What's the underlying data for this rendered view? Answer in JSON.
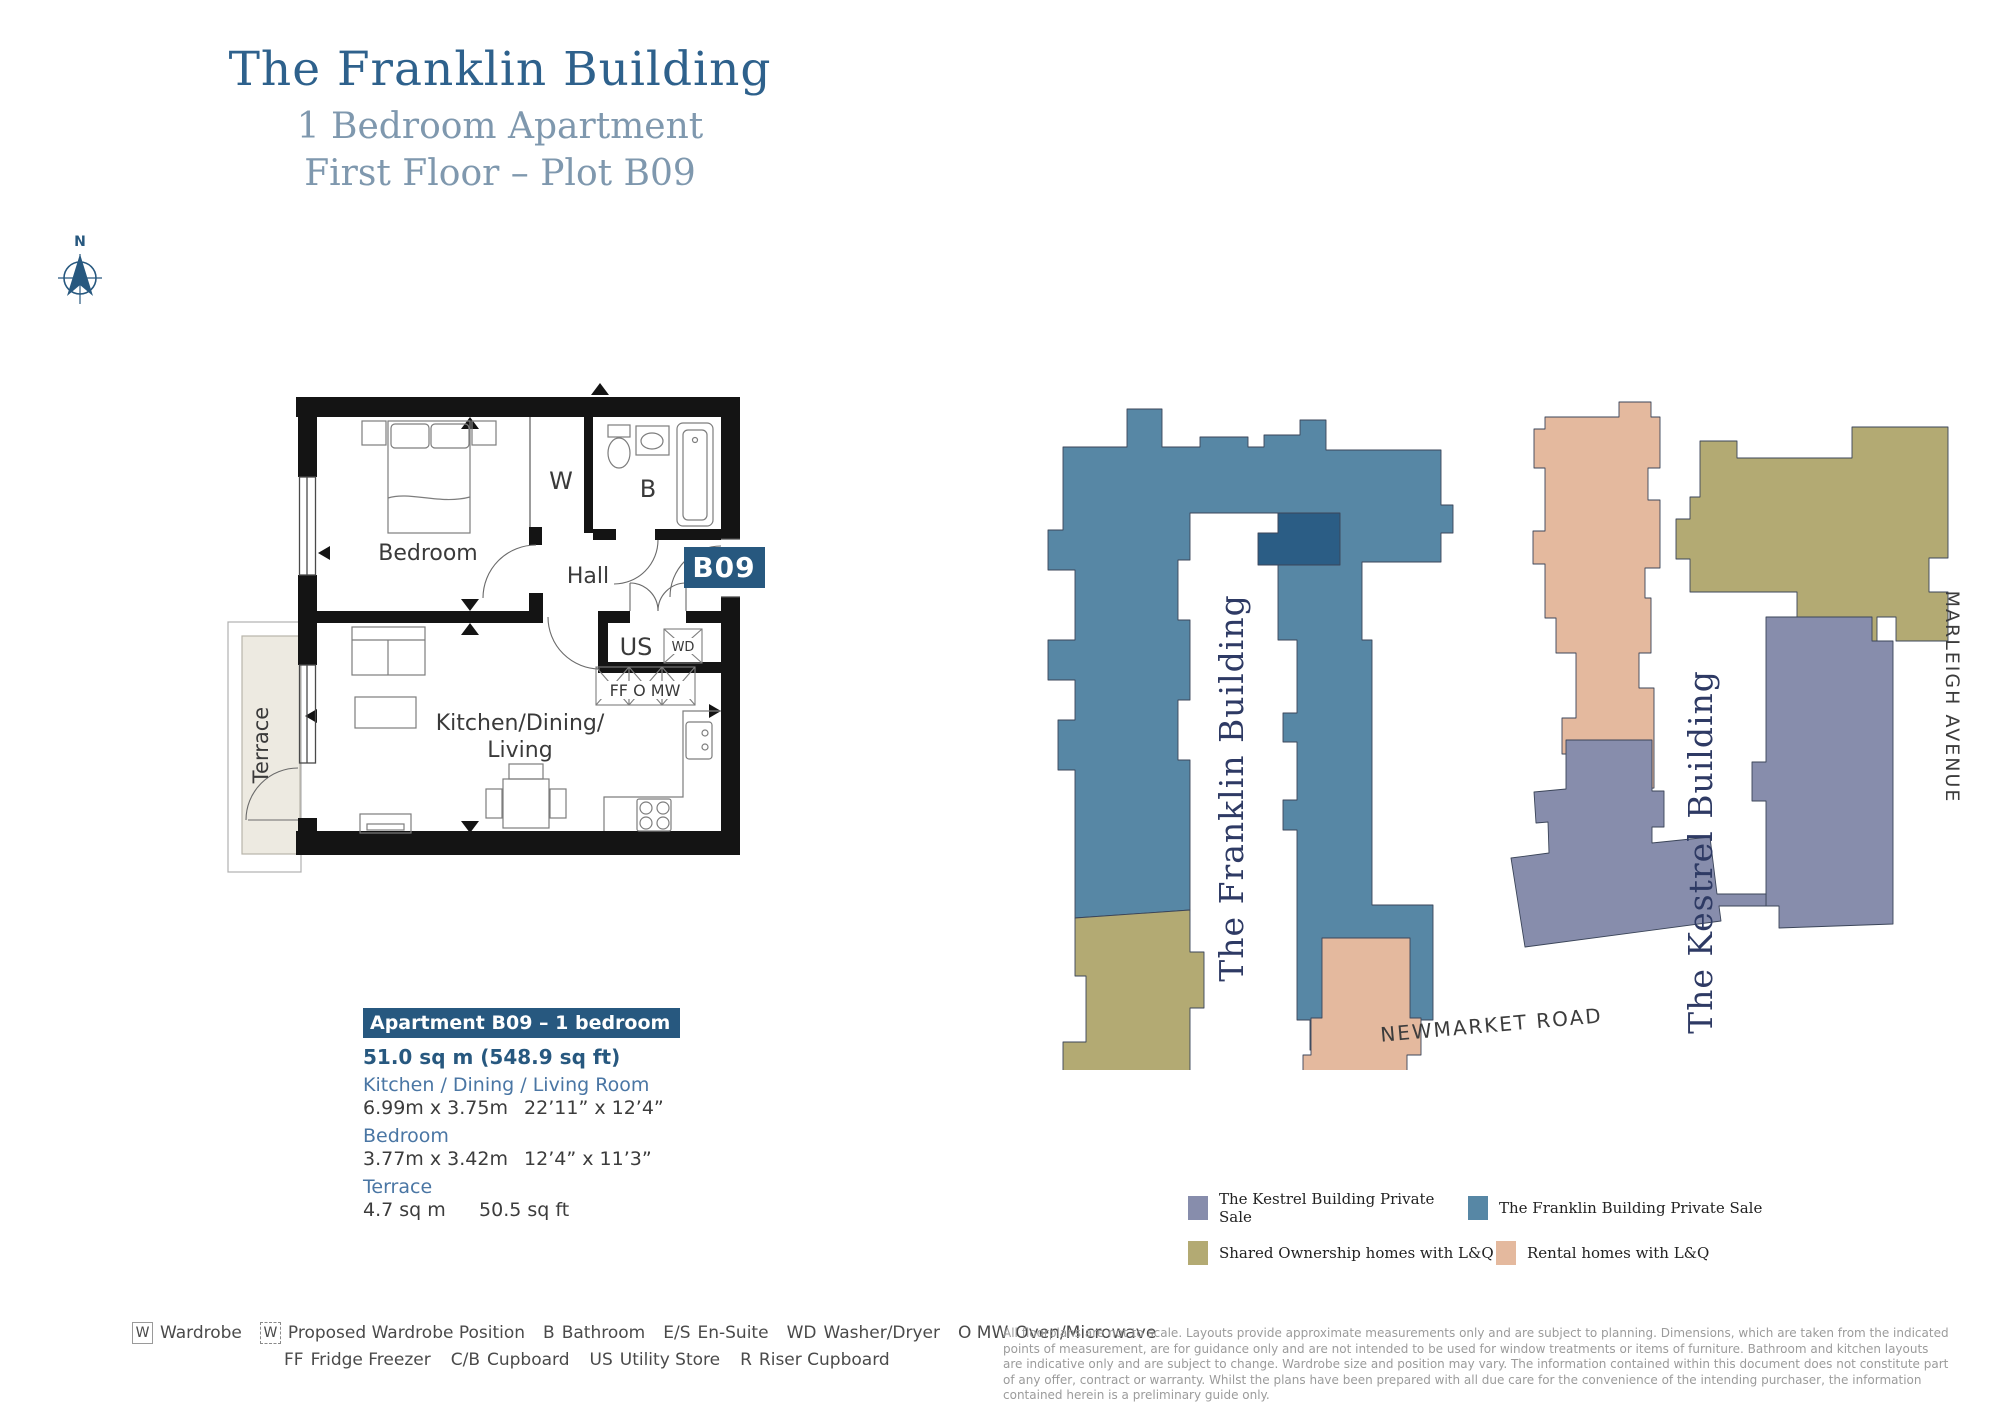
{
  "title": {
    "line1": "The Franklin Building",
    "line2": "1 Bedroom Apartment",
    "line3": "First Floor – Plot B09"
  },
  "compass": {
    "north": "N"
  },
  "floorplan": {
    "badge": "B09",
    "labels": {
      "bedroom": "Bedroom",
      "hall": "Hall",
      "wardrobe": "W",
      "bathroom": "B",
      "utility_store": "US",
      "washer_dryer": "WD",
      "appliances": "FF O MW",
      "kitchen_line1": "Kitchen/Dining/",
      "kitchen_line2": "Living",
      "terrace": "Terrace"
    }
  },
  "apartment_info": {
    "header": "Apartment B09 – 1 bedroom",
    "area": "51.0 sq m (548.9 sq ft)",
    "rooms": [
      {
        "name": "Kitchen / Dining / Living Room",
        "metric": "6.99m x 3.75m",
        "imperial": "22’11” x 12’4”"
      },
      {
        "name": "Bedroom",
        "metric": "3.77m x 3.42m",
        "imperial": "12’4” x 11’3”"
      },
      {
        "name": "Terrace",
        "metric": "4.7 sq m",
        "imperial": "50.5 sq ft"
      }
    ]
  },
  "site_plan": {
    "franklin_label": "The Franklin Building",
    "kestrel_label": "The Kestrel Building",
    "road_bottom": "NEWMARKET ROAD",
    "road_right": "MARLEIGH AVENUE"
  },
  "legend": {
    "items": [
      {
        "label": "The Kestrel Building Private Sale"
      },
      {
        "label": "The Franklin Building Private Sale"
      },
      {
        "label": "Shared Ownership homes with L&Q"
      },
      {
        "label": "Rental homes with L&Q"
      }
    ]
  },
  "key": {
    "row1": [
      {
        "abbr": "W",
        "label": "Wardrobe"
      },
      {
        "abbr": "W",
        "label": "Proposed Wardrobe Position"
      },
      {
        "abbr": "B",
        "label": "Bathroom"
      },
      {
        "abbr": "E/S",
        "label": "En-Suite"
      },
      {
        "abbr": "WD",
        "label": "Washer/Dryer"
      },
      {
        "abbr": "O MW",
        "label": "Oven/Microwave"
      }
    ],
    "row2": [
      {
        "abbr": "FF",
        "label": "Fridge Freezer"
      },
      {
        "abbr": "C/B",
        "label": "Cupboard"
      },
      {
        "abbr": "US",
        "label": "Utility Store"
      },
      {
        "abbr": "R",
        "label": "Riser Cupboard"
      }
    ]
  },
  "disclaimer": "All floorplans are not to scale. Layouts provide approximate measurements only and are subject to planning. Dimensions, which are taken from the indicated points of measurement, are for guidance only and are not intended to be used for window treatments or items of furniture. Bathroom and kitchen layouts are indicative only and are subject to change. Wardrobe size and position may vary. The information contained within this document does not constitute part of any offer, contract or warranty. Whilst the plans have been prepared with all due care for the convenience of the intending purchaser, the information contained herein is a preliminary guide only.",
  "colors": {
    "brand": "#27587f",
    "title": "#2e618c",
    "subtitle": "#7f98ae",
    "franklin": "#5787a5",
    "franklin_highlight": "#2b5d85",
    "kestrel": "#878dac",
    "shared_ownership": "#b3aa73",
    "rental": "#e4b99e",
    "site_label": "#2e3a64"
  }
}
